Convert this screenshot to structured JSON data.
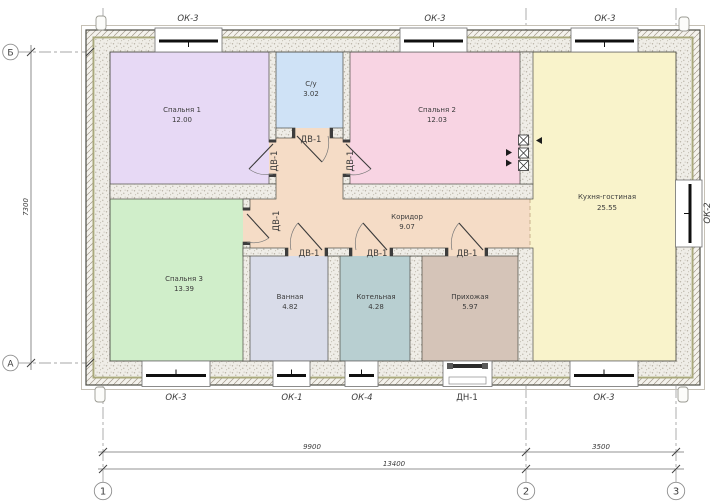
{
  "drawing": {
    "type": "floor-plan",
    "rooms": [
      {
        "name": "Спальня 1",
        "area": "12.00",
        "color": "#e7d9f5"
      },
      {
        "name": "С/у",
        "area": "3.02",
        "color": "#cfe2f6"
      },
      {
        "name": "Спальня 2",
        "area": "12.03",
        "color": "#f8d4e3"
      },
      {
        "name": "Кухня-гостиная",
        "area": "25.55",
        "color": "#f9f3cb"
      },
      {
        "name": "Спальня 3",
        "area": "13.39",
        "color": "#d0eeca"
      },
      {
        "name": "Коридор",
        "area": "9.07",
        "color": "#f5dcc6"
      },
      {
        "name": "Ванная",
        "area": "4.82",
        "color": "#d9dce9"
      },
      {
        "name": "Котельная",
        "area": "4.28",
        "color": "#b8cfd1"
      },
      {
        "name": "Прихожая",
        "area": "5.97",
        "color": "#d5c4b8"
      }
    ],
    "openings": {
      "windows_top": [
        "ОК-3",
        "ОК-3",
        "ОК-3"
      ],
      "windows_bottom": [
        "ОК-3",
        "ОК-1",
        "ОК-4",
        "ОК-3"
      ],
      "window_right": "ОК-2",
      "entry_door": "ДН-1",
      "interior_door": "ДВ-1"
    },
    "axes": {
      "rows": [
        "Б",
        "А"
      ],
      "cols": [
        "1",
        "2",
        "3"
      ]
    },
    "dimensions": {
      "span_1_2": "9900",
      "span_2_3": "3500",
      "total_width": "13400",
      "total_height": "7300"
    },
    "colors": {
      "wall_outline": "#4c4c44",
      "insulation_line": "#a9a87b",
      "masonry_fill": "#efede7",
      "glazing": "#101010"
    }
  }
}
